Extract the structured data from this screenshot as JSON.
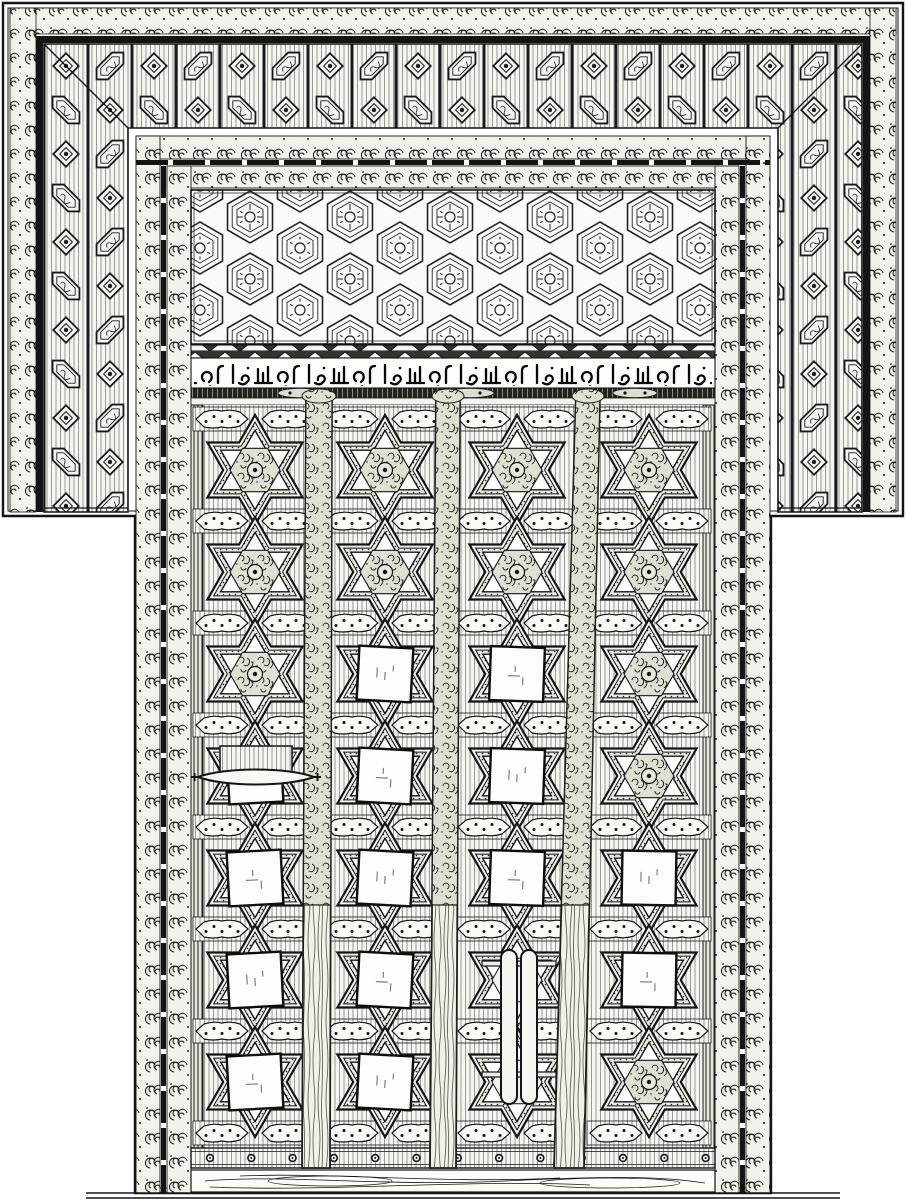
{
  "figure": {
    "description": "Black-and-white engraved plate of an ornate carved wooden double door in Islamic style: a wide geometric strapwork frame, a honeycomb rosette lintel panel, a band of Arabic calligraphy, and door leaves decorated with rows of six-pointed stars, some holding plain square panels, with a horizontal spindle handle and a vertical pull handle.",
    "ink_color": "#141414",
    "paper_color": "#ffffff"
  },
  "frame": {
    "outer_border": "double ruled line",
    "scroll_band": "running C-scroll border",
    "geometric_band": "lattice of elongated hexagons and diamonds",
    "legs_end_y": 512
  },
  "panels": {
    "honeycomb": {
      "motif": "hexagonal rosettes with central ring",
      "rows_visible": 3
    },
    "inscription": {
      "script": "arabic-calligraphy",
      "zigzag_border": true,
      "dark_medallion_band": true
    }
  },
  "door": {
    "columns": [
      255,
      385,
      517,
      649
    ],
    "rows": [
      470,
      572,
      674,
      776,
      878,
      980,
      1082
    ],
    "band_ys": [
      419,
      521,
      623,
      725,
      827,
      929,
      1031,
      1133
    ],
    "star_radius": 55,
    "square_cells": [
      "0-3",
      "0-4",
      "0-5",
      "0-6",
      "1-2",
      "1-3",
      "1-4",
      "1-5",
      "1-6",
      "2-2",
      "2-3",
      "2-4",
      "3-4",
      "3-5"
    ],
    "white_cells": [
      "2-5",
      "2-6"
    ],
    "battens": [
      {
        "x_top": 306,
        "w_top": 26,
        "x_bot": 302,
        "w_bot": 28
      },
      {
        "x_top": 436,
        "w_top": 24,
        "x_bot": 430,
        "w_bot": 26
      },
      {
        "x_top": 576,
        "w_top": 24,
        "x_bot": 554,
        "w_bot": 30
      }
    ],
    "batten_y": {
      "top": 392,
      "bottom": 1168,
      "foliage_until": 905
    },
    "nails": {
      "count": 13,
      "y": 1158,
      "x_start": 210,
      "spacing": 41.3
    },
    "handles": {
      "spindle": {
        "x1": 198,
        "x2": 314,
        "y": 777
      },
      "pull": {
        "cx": 519,
        "y1": 950,
        "y2": 1104,
        "pin_x1": 482,
        "pin_x2": 556,
        "pin_y1": 961,
        "pin_y2": 1072
      }
    }
  }
}
